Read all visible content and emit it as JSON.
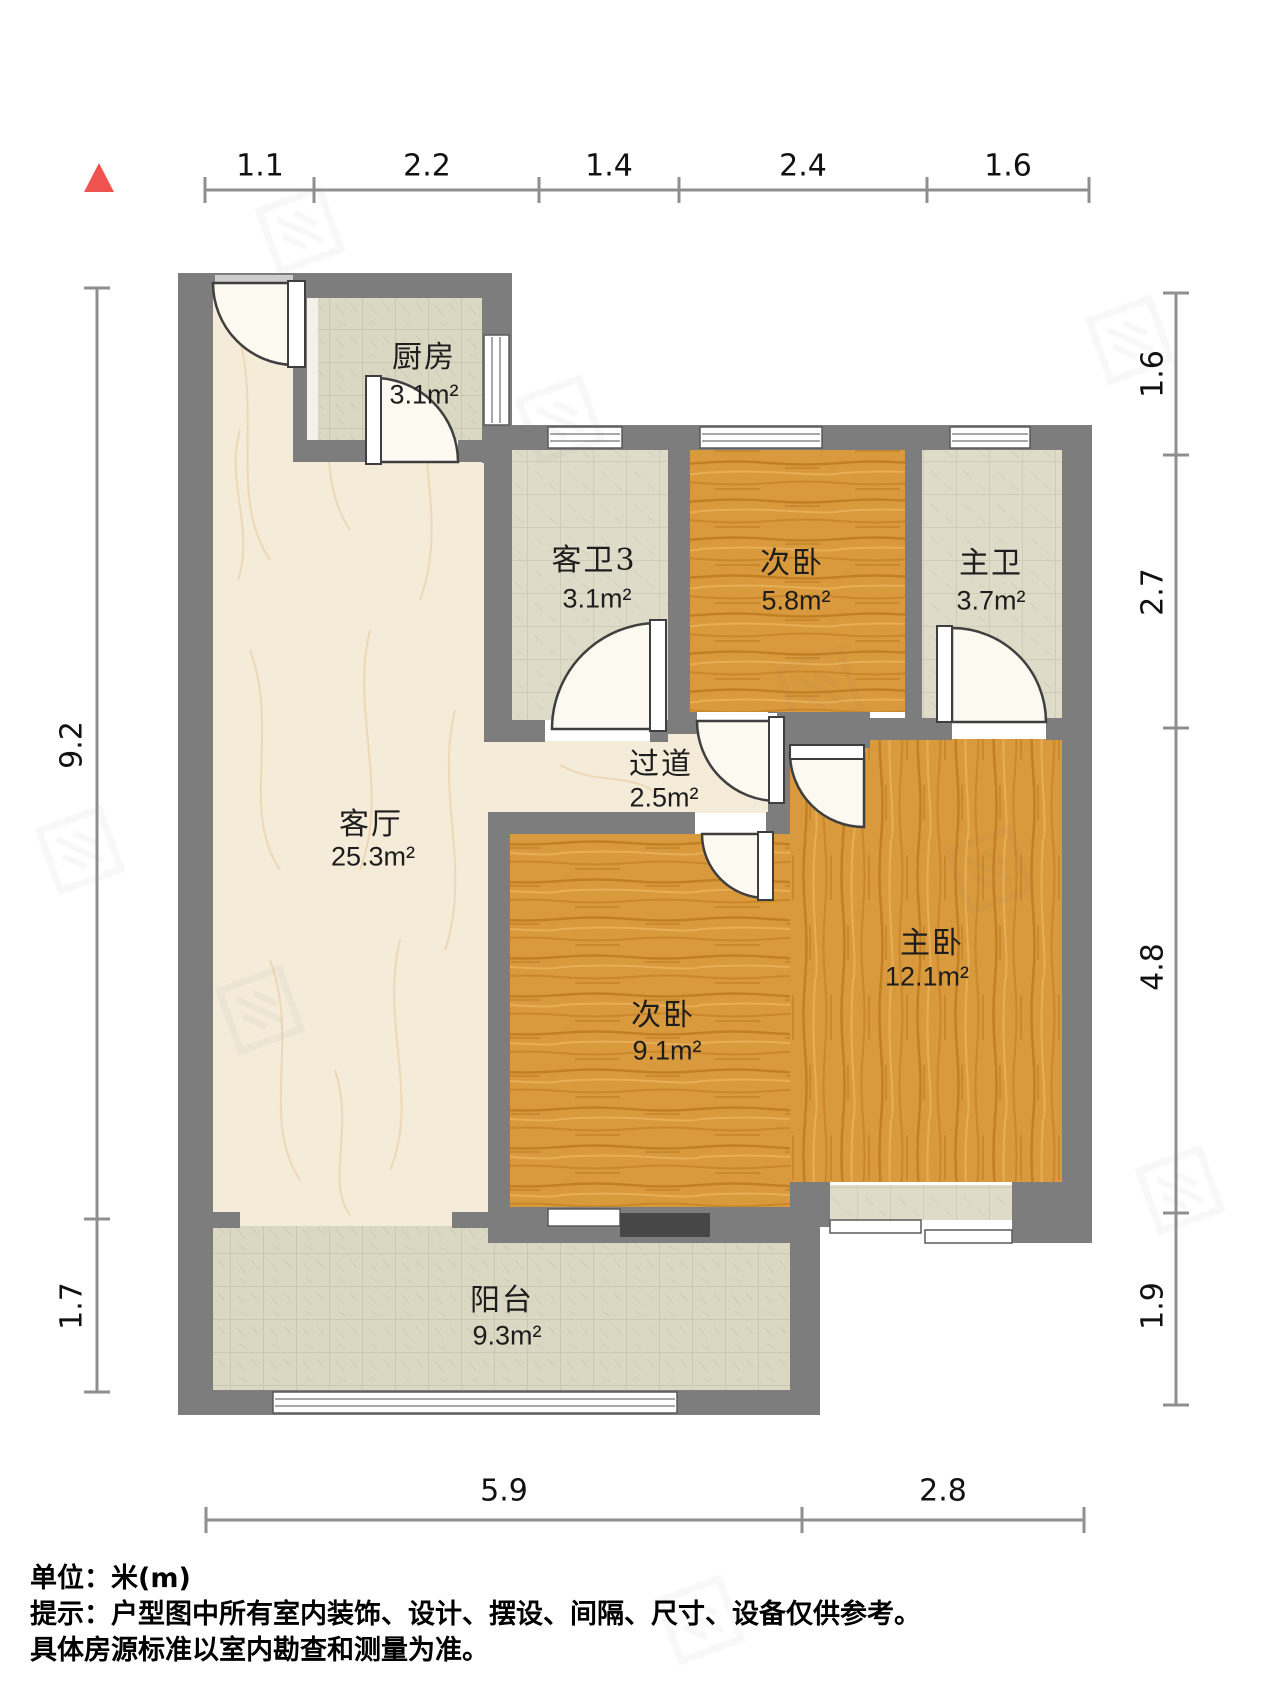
{
  "floorplan": {
    "rooms": [
      {
        "id": "kitchen",
        "name": "厨房",
        "area": "3.1m²"
      },
      {
        "id": "guest-bathroom",
        "name": "客卫3",
        "area": "3.1m²"
      },
      {
        "id": "bedroom2-upper",
        "name": "次卧",
        "area": "5.8m²"
      },
      {
        "id": "master-bathroom",
        "name": "主卫",
        "area": "3.7m²"
      },
      {
        "id": "hallway",
        "name": "过道",
        "area": "2.5m²"
      },
      {
        "id": "living-room",
        "name": "客厅",
        "area": "25.3m²"
      },
      {
        "id": "bedroom2-lower",
        "name": "次卧",
        "area": "9.1m²"
      },
      {
        "id": "master-bedroom",
        "name": "主卧",
        "area": "12.1m²"
      },
      {
        "id": "balcony",
        "name": "阳台",
        "area": "9.3m²"
      }
    ],
    "dimensions": {
      "top": [
        "1.1",
        "2.2",
        "1.4",
        "2.4",
        "1.6"
      ],
      "left": [
        "9.2",
        "1.7"
      ],
      "right": [
        "1.6",
        "2.7",
        "4.8",
        "1.9"
      ],
      "bottom": [
        "5.9",
        "2.8"
      ]
    },
    "footer": {
      "unit_line": "单位：米(m)",
      "hint_line1": "提示：户型图中所有室内装饰、设计、摆设、间隔、尺寸、设备仅供参考。",
      "hint_line2": "具体房源标准以室内勘查和测量为准。"
    },
    "colors": {
      "wall": "#7d7d7d",
      "wood": "#d9993d",
      "tile": "#dad7c2",
      "marble": "#f4ebd9",
      "north_marker_red": "#ef5350",
      "dimension_line": "#8f8f8f"
    }
  }
}
